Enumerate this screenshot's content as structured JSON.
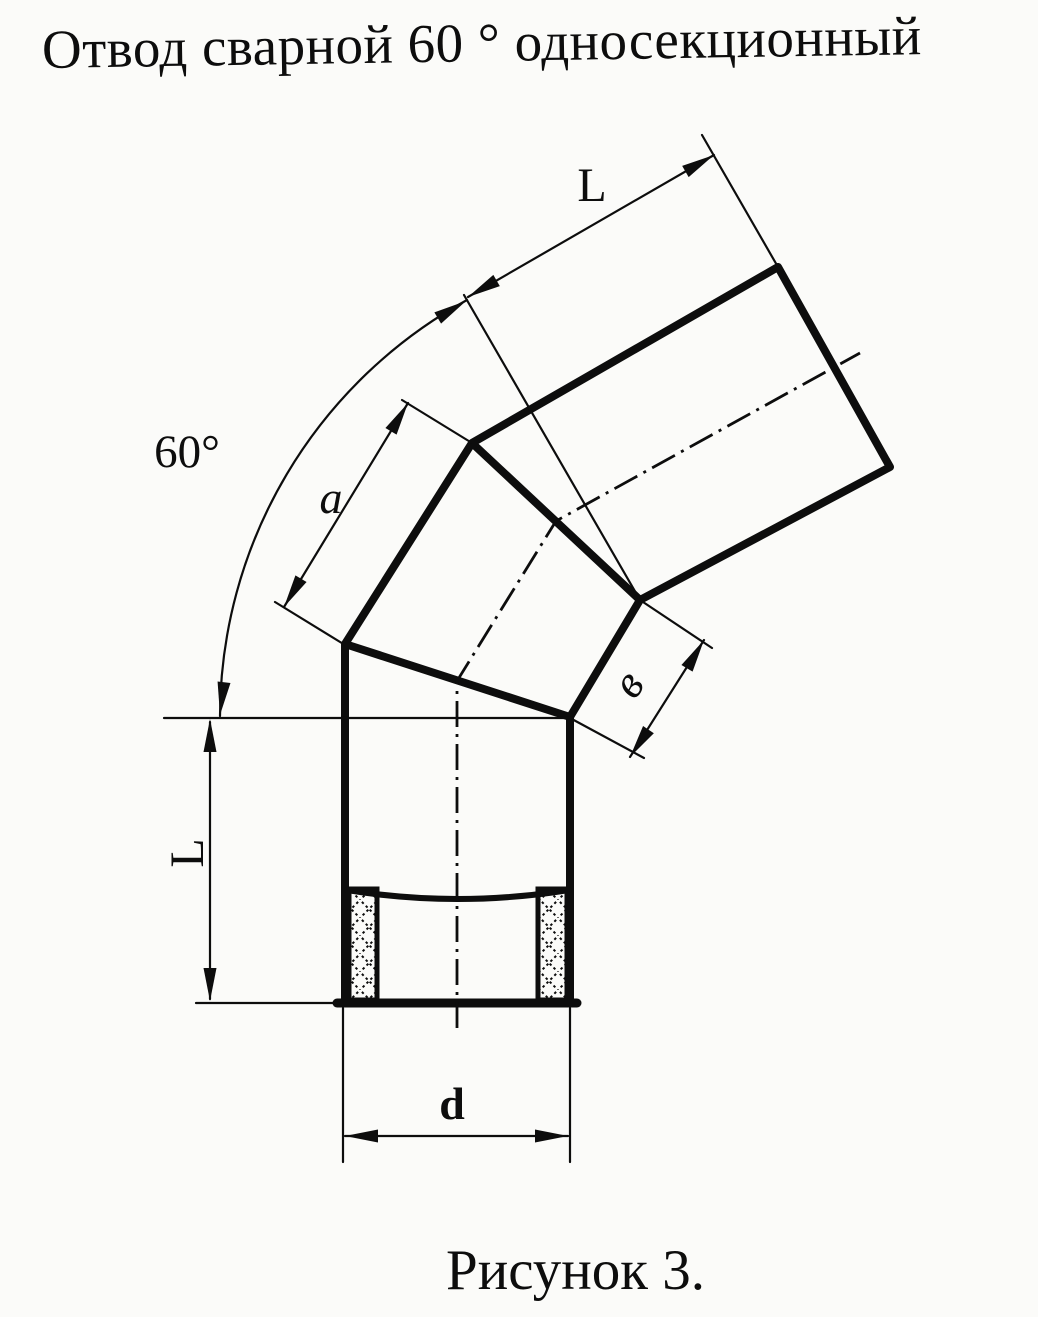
{
  "page": {
    "background": "#fbfbf9",
    "ink": "#0d0d0d"
  },
  "title": "Отвод сварной 60 ° односекционный",
  "caption": "Рисунок 3.",
  "labels": {
    "angle": "60°",
    "upper_length": "L",
    "side_a": "а",
    "side_b": "в",
    "lower_length": "L",
    "diameter": "d"
  }
}
